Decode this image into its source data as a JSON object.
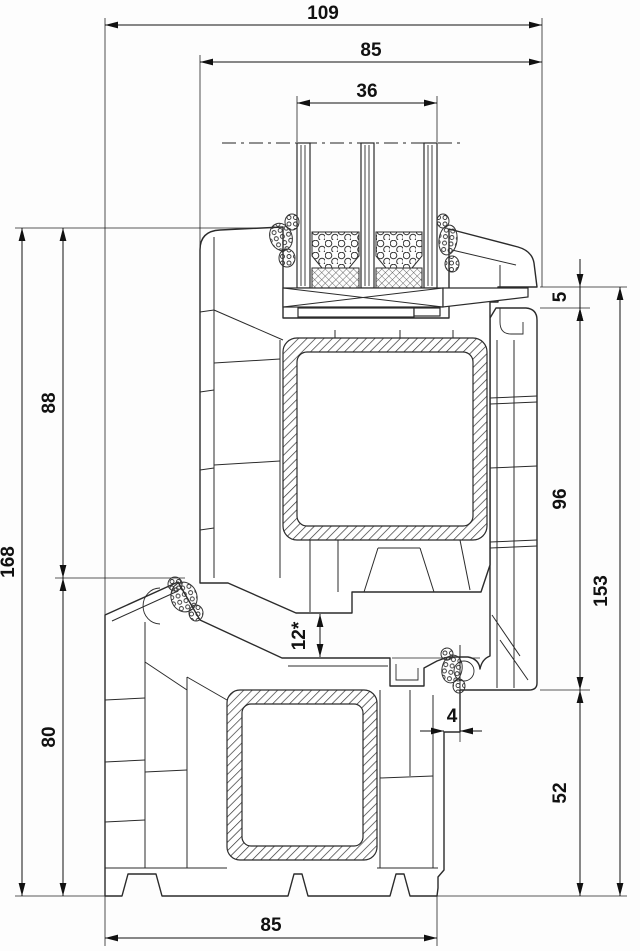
{
  "drawing": {
    "dims": {
      "d109": "109",
      "d85_top": "85",
      "d36": "36",
      "d168": "168",
      "d88": "88",
      "d80": "80",
      "d5": "5",
      "d96": "96",
      "d153": "153",
      "d12": "12*",
      "d4": "4",
      "d52": "52",
      "d85_bottom": "85"
    },
    "colors": {
      "line": "#2b2b2b",
      "dimension": "#111111",
      "text": "#111111",
      "background": "#fdfdfd"
    }
  }
}
